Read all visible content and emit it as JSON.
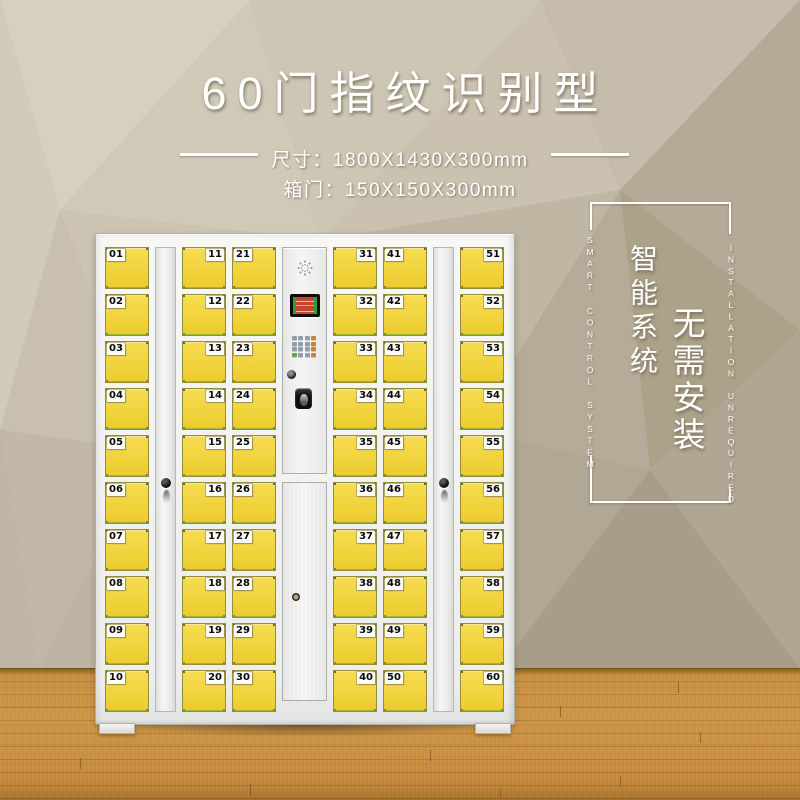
{
  "title": "60门指纹识别型",
  "specs": {
    "size_line": "尺寸：1800X1430X300mm",
    "door_line": "箱门：150X150X300mm"
  },
  "feature_block": {
    "cn_smart": "智能系统",
    "cn_install": "无需安装",
    "en_smart": "SMART CONTROL SYSTEM",
    "en_install": "INSTALLATION UNREQUIRED"
  },
  "locker": {
    "columns": [
      {
        "type": "doors",
        "label_side": "left",
        "numbers": [
          "01",
          "02",
          "03",
          "04",
          "05",
          "06",
          "07",
          "08",
          "09",
          "10"
        ]
      },
      {
        "type": "strip"
      },
      {
        "type": "doors",
        "label_side": "right",
        "numbers": [
          "11",
          "12",
          "13",
          "14",
          "15",
          "16",
          "17",
          "18",
          "19",
          "20"
        ]
      },
      {
        "type": "doors",
        "label_side": "left",
        "numbers": [
          "21",
          "22",
          "23",
          "24",
          "25",
          "26",
          "27",
          "28",
          "29",
          "30"
        ]
      },
      {
        "type": "panel"
      },
      {
        "type": "doors",
        "label_side": "right",
        "numbers": [
          "31",
          "32",
          "33",
          "34",
          "35",
          "36",
          "37",
          "38",
          "39",
          "40"
        ]
      },
      {
        "type": "doors",
        "label_side": "left",
        "numbers": [
          "41",
          "42",
          "43",
          "44",
          "45",
          "46",
          "47",
          "48",
          "49",
          "50"
        ]
      },
      {
        "type": "strip"
      },
      {
        "type": "doors",
        "label_side": "right",
        "numbers": [
          "51",
          "52",
          "53",
          "54",
          "55",
          "56",
          "57",
          "58",
          "59",
          "60"
        ]
      }
    ]
  },
  "colors": {
    "door_yellow": "#f1d33f",
    "cabinet_white": "#f2f2f0",
    "wall_beige": "#c6bcab",
    "floor_wood": "#c78d3e",
    "keypad_function_orange": "#d07f2c",
    "keypad_ok_green": "#54ad4c",
    "screen_red": "#c4462f",
    "screen_green": "#2f9e35",
    "text_white": "#ffffff"
  }
}
